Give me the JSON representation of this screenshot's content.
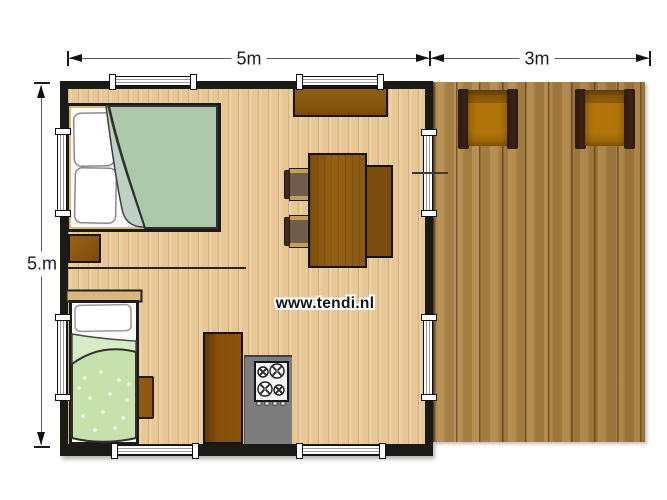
{
  "watermark": {
    "text": "www.tendi.nl"
  },
  "dimensions": {
    "width_main": "5m",
    "width_deck": "3m",
    "height_main": "5.m"
  },
  "colors": {
    "wall": "#1b1a17",
    "floor": "#e8c795",
    "deck": "#ab8142",
    "counter_gray": "#7d7d7d",
    "furniture_brown": "#8a5a12",
    "furniture_dark_brown": "#7b4c0e",
    "chair_seat": "#b1750b",
    "chair_arm": "#3a2316",
    "duvet_double": "#adc9ab",
    "duvet_double_fold": "#bdd1c6",
    "duvet_single": "#c6e1ac",
    "duvet_single_fold": "#d8ebc6"
  }
}
